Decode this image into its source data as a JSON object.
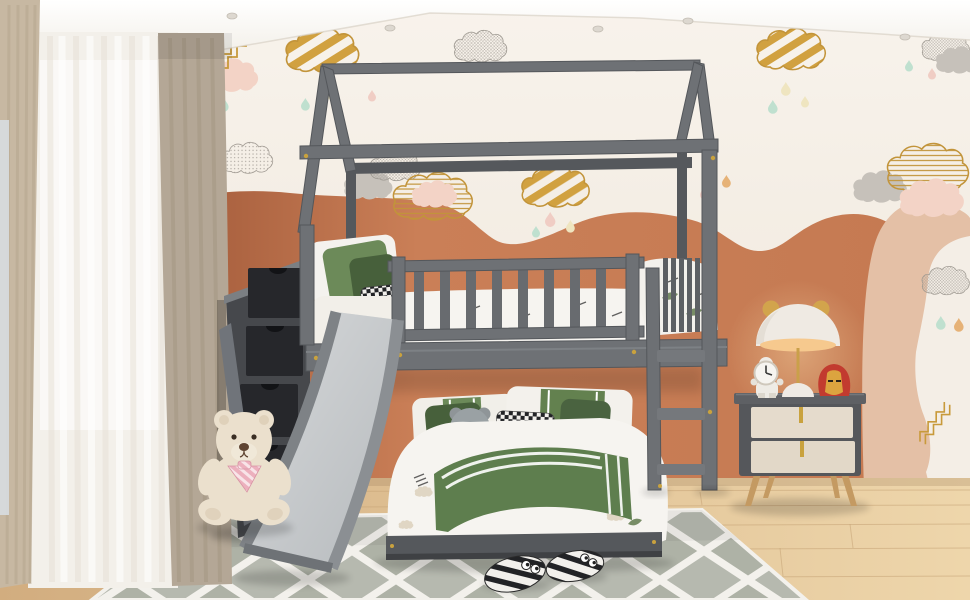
{
  "meta": {
    "title": "Kids bedroom with gray house bunk bed, slide and storage staircase",
    "width": 970,
    "height": 600
  },
  "labels": {
    "scene": "Children's bedroom with gray house-frame bunk bed, slide, storage staircase, nightstand and toys",
    "ceiling": "White ceiling with recessed spotlights",
    "wall": "White wall with cloud and raindrop decals over terracotta wave mural",
    "window": "Window with sheer curtain and drapes",
    "floor": "Light oak wood floor",
    "rug": "White and gray trellis area rug",
    "bunk_bed_frame": "Gray house-frame bunk bed",
    "top_bunk": "Top bunk with slatted guardrail and green pillows",
    "bottom_bunk": "Bottom bunk with white and green bedding",
    "slide": "Gray play slide",
    "staircase": "Storage staircase with dark drawers",
    "ladder": "Gray access ladder",
    "nightstand": "Two-drawer nightstand with wooden legs",
    "lamp": "White mushroom lamp with gold ears",
    "astronaut": "Astronaut clock figurine",
    "ironman": "Iron Man helmet toy",
    "teddy": "Cream teddy bear with pink bow",
    "slippers": "Black and white striped kids slippers"
  },
  "colors": {
    "ceiling": "#fbf9f6",
    "wall": "#f6f0e8",
    "terracotta": "#c47a53",
    "peach_arch": "#e4c0a6",
    "pink_cloud": "#f3d3c6",
    "gray_cloud": "#c6c1ba",
    "gold": "#d1a140",
    "teal_drop": "#bfe0cf",
    "cream_drop": "#efe5c0",
    "orange_drop": "#e6b277",
    "pink_drop": "#f0cdc4",
    "bed_frame": "#6e7175",
    "bed_frame_dark": "#55585c",
    "drawer_face": "#26272b",
    "stair_body": "#46484c",
    "slide_surface": "#b6babd",
    "slide_rail": "#7e8286",
    "bedding_white": "#f6f4f0",
    "pillow_green": "#6c8a59",
    "pillow_green_dark": "#47603b",
    "blanket_green": "#5e7e4e",
    "curtain_tan": "#c7b8a2",
    "curtain_taupe": "#b4a796",
    "sky_sliver": "#d7dde0",
    "floor_wood": "#e2c49a",
    "rug_field": "#b6b9af",
    "rug_line": "#f3f1ec",
    "nightstand_body": "#55575b",
    "nightstand_drawer": "#e5dbcc",
    "wood_leg": "#c49a62",
    "lamp_white": "#efeae3",
    "lamp_glow": "#f6c98e",
    "ironman_red": "#c23b2f",
    "ironman_gold": "#dca43f",
    "teddy_fur": "#ebe0cd",
    "bow_pink": "#ecb0bd",
    "brass": "#c9a23e"
  }
}
